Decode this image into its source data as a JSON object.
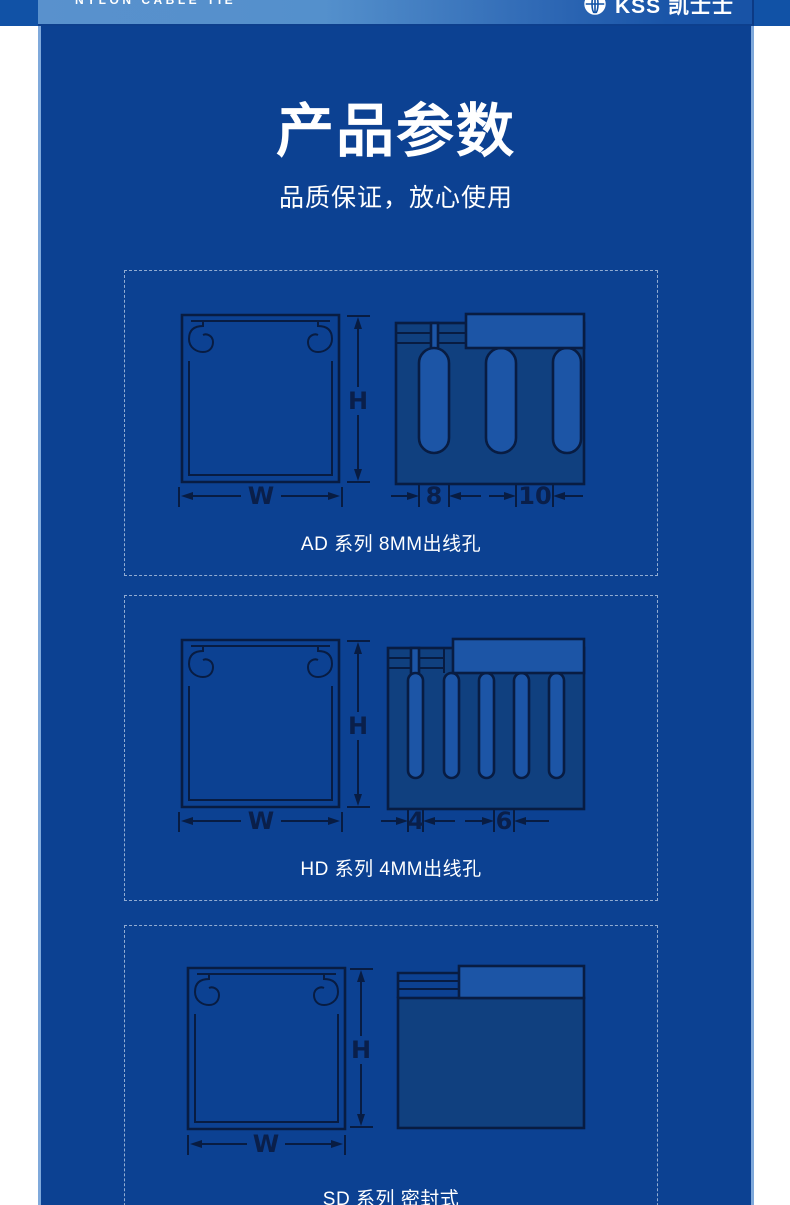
{
  "header": {
    "tagline": "NYLON CABLE TIE",
    "brand": "KSS 凯士士",
    "logo_icon": "globe-icon"
  },
  "hero": {
    "title": "产品参数",
    "subtitle": "品质保证，放心使用"
  },
  "panels": [
    {
      "series": "AD",
      "caption": "AD 系列 8MM出线孔",
      "dims": {
        "width_label": "W",
        "height_label": "H",
        "slot_label": "8",
        "pitch_label": "10"
      }
    },
    {
      "series": "HD",
      "caption": "HD 系列 4MM出线孔",
      "dims": {
        "width_label": "W",
        "height_label": "H",
        "slot_label": "4",
        "pitch_label": "6"
      }
    },
    {
      "series": "SD",
      "caption": "SD 系列 密封式",
      "dims": {
        "width_label": "W",
        "height_label": "H"
      }
    }
  ],
  "colors": {
    "column_background": "#0c4192",
    "band_background": "#1152a6",
    "band_gradient_start": "#5991cd",
    "band_gradient_end": "#1853a6",
    "edge_line": "#7fa9db",
    "diagram_line": "#081c42",
    "diagram_body_fill": "#10407f",
    "diagram_light_fill": "#1c55a6",
    "text": "#ffffff"
  }
}
